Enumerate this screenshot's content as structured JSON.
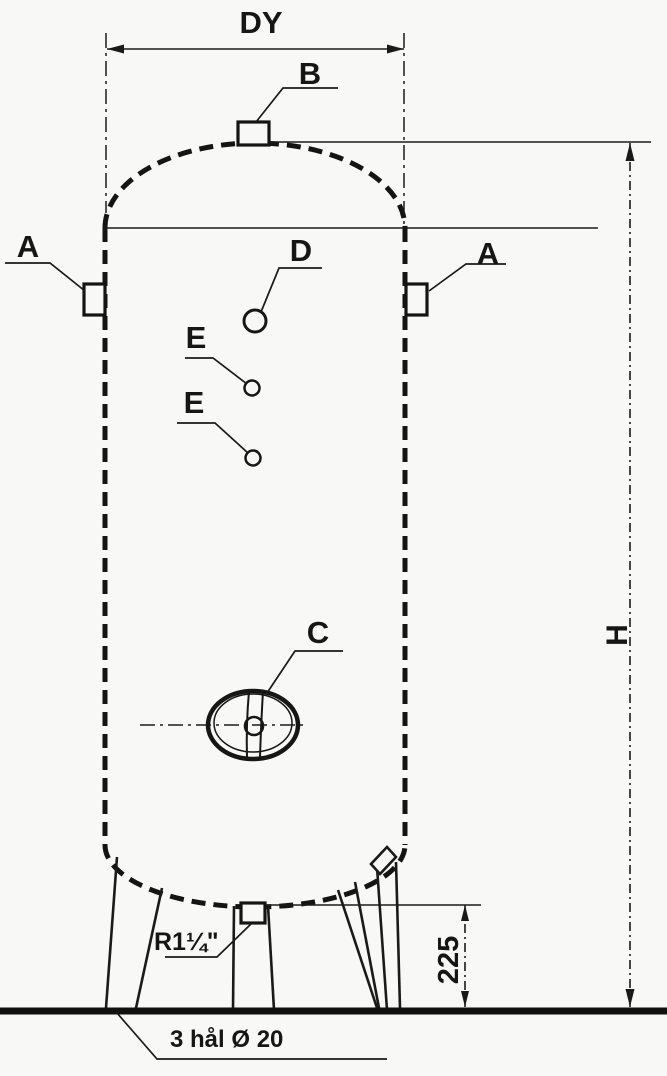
{
  "drawing": {
    "type": "technical-drawing",
    "subject": "vertical pressure vessel with three legs",
    "colors": {
      "ink": "#1a1a1a",
      "paper": "#f8f8f6"
    },
    "dimensions": {
      "diameter_label": "DY",
      "height_label": "H",
      "leg_height_value": "225"
    },
    "connections": {
      "top_nozzle": "B",
      "side_nozzle_left": "A",
      "side_nozzle_right": "A",
      "front_opening_d": "D",
      "front_opening_e_upper": "E",
      "front_opening_e_lower": "E",
      "manhole": "C",
      "drain_size": "R1¼\""
    },
    "notes": {
      "foot_holes": "3 hål Ø 20"
    }
  }
}
